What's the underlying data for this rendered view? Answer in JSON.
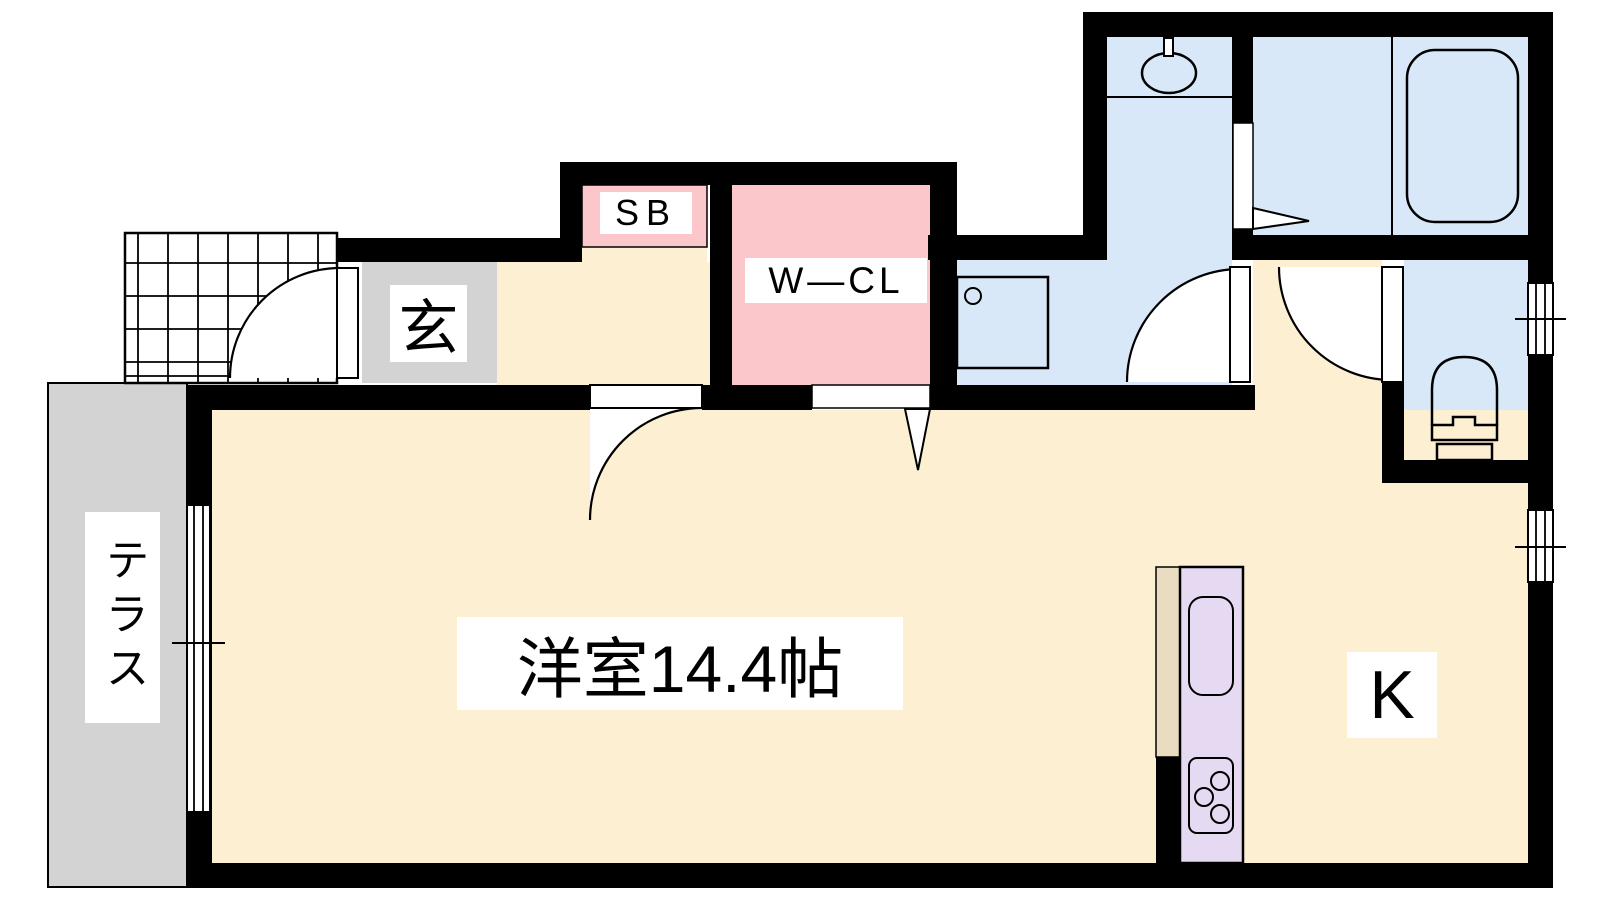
{
  "plan_title": "1K apartment floor plan",
  "rooms": {
    "western_room": {
      "label": "洋室14.4帖",
      "type": "western-style room",
      "size_jo": 14.4
    },
    "kitchen": {
      "label": "K",
      "type": "kitchen"
    },
    "genkan": {
      "label": "玄",
      "type": "entrance"
    },
    "shoe_box": {
      "label": "SB",
      "type": "shoe box"
    },
    "walk_in_closet": {
      "label": "W―CL",
      "type": "walk-in closet"
    },
    "terrace": {
      "label": "テラス",
      "type": "terrace"
    },
    "washroom": {
      "label": "",
      "type": "washroom / laundry"
    },
    "bathroom": {
      "label": "",
      "type": "bathroom"
    },
    "toilet": {
      "label": "",
      "type": "toilet"
    }
  },
  "icons": [
    "washbasin-icon",
    "bathtub-icon",
    "toilet-icon",
    "washing-machine-pan-icon",
    "kitchen-sink-icon",
    "stove-icon",
    "door-swing-arc",
    "sliding-window",
    "tile-porch-grid"
  ],
  "colors": {
    "wall": "#000000",
    "floor-wood": "#FCEFD2",
    "floor-wet": "#D9E8F8",
    "floor-pink": "#FBC7CA",
    "floor-gray": "#D3D3D3",
    "counter-purple": "#E6DAF2",
    "counter-beige": "#EADCC1",
    "label-bg": "#FFFFFF",
    "ink": "#000000"
  }
}
